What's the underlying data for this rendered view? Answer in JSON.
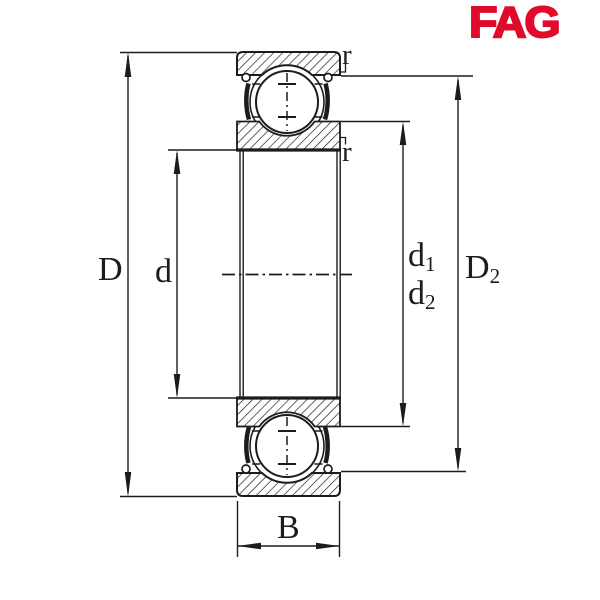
{
  "brand": {
    "logo_text": "FAG",
    "color": "#E00A2B"
  },
  "drawing": {
    "type": "bearing-cross-section",
    "line_color": "#1c1c1c",
    "background": "#ffffff"
  },
  "labels": {
    "outer_diameter": {
      "main": "D",
      "sub": ""
    },
    "bore_diameter": {
      "main": "d",
      "sub": ""
    },
    "recess_diameter_1": {
      "main": "d",
      "sub": "1"
    },
    "recess_diameter_2": {
      "main": "d",
      "sub": "2"
    },
    "shoulder_diameter": {
      "main": "D",
      "sub": "2"
    },
    "width": {
      "main": "B",
      "sub": ""
    },
    "chamfer_radius_outer": "r",
    "chamfer_radius_inner": "r"
  }
}
